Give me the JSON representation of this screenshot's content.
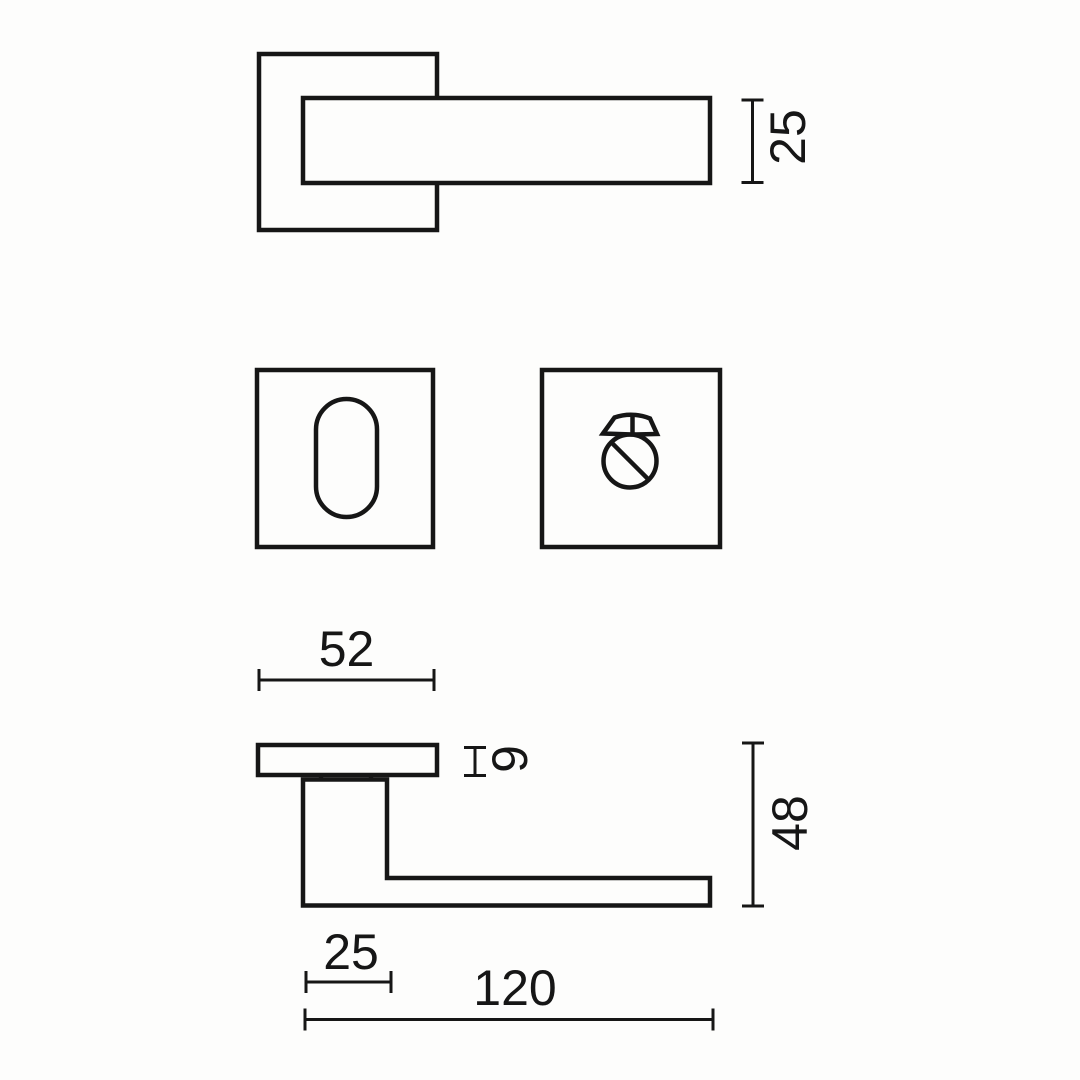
{
  "page": {
    "colors": {
      "background": "#fdfdfc",
      "line": "#161616"
    }
  },
  "views": {
    "front": {
      "dims": {
        "lever_section_height": "25"
      }
    },
    "side": {
      "dims": {
        "rose_width": "52",
        "rose_thickness": "9",
        "handle_height": "48",
        "neck_width": "25",
        "handle_length": "120"
      }
    }
  }
}
